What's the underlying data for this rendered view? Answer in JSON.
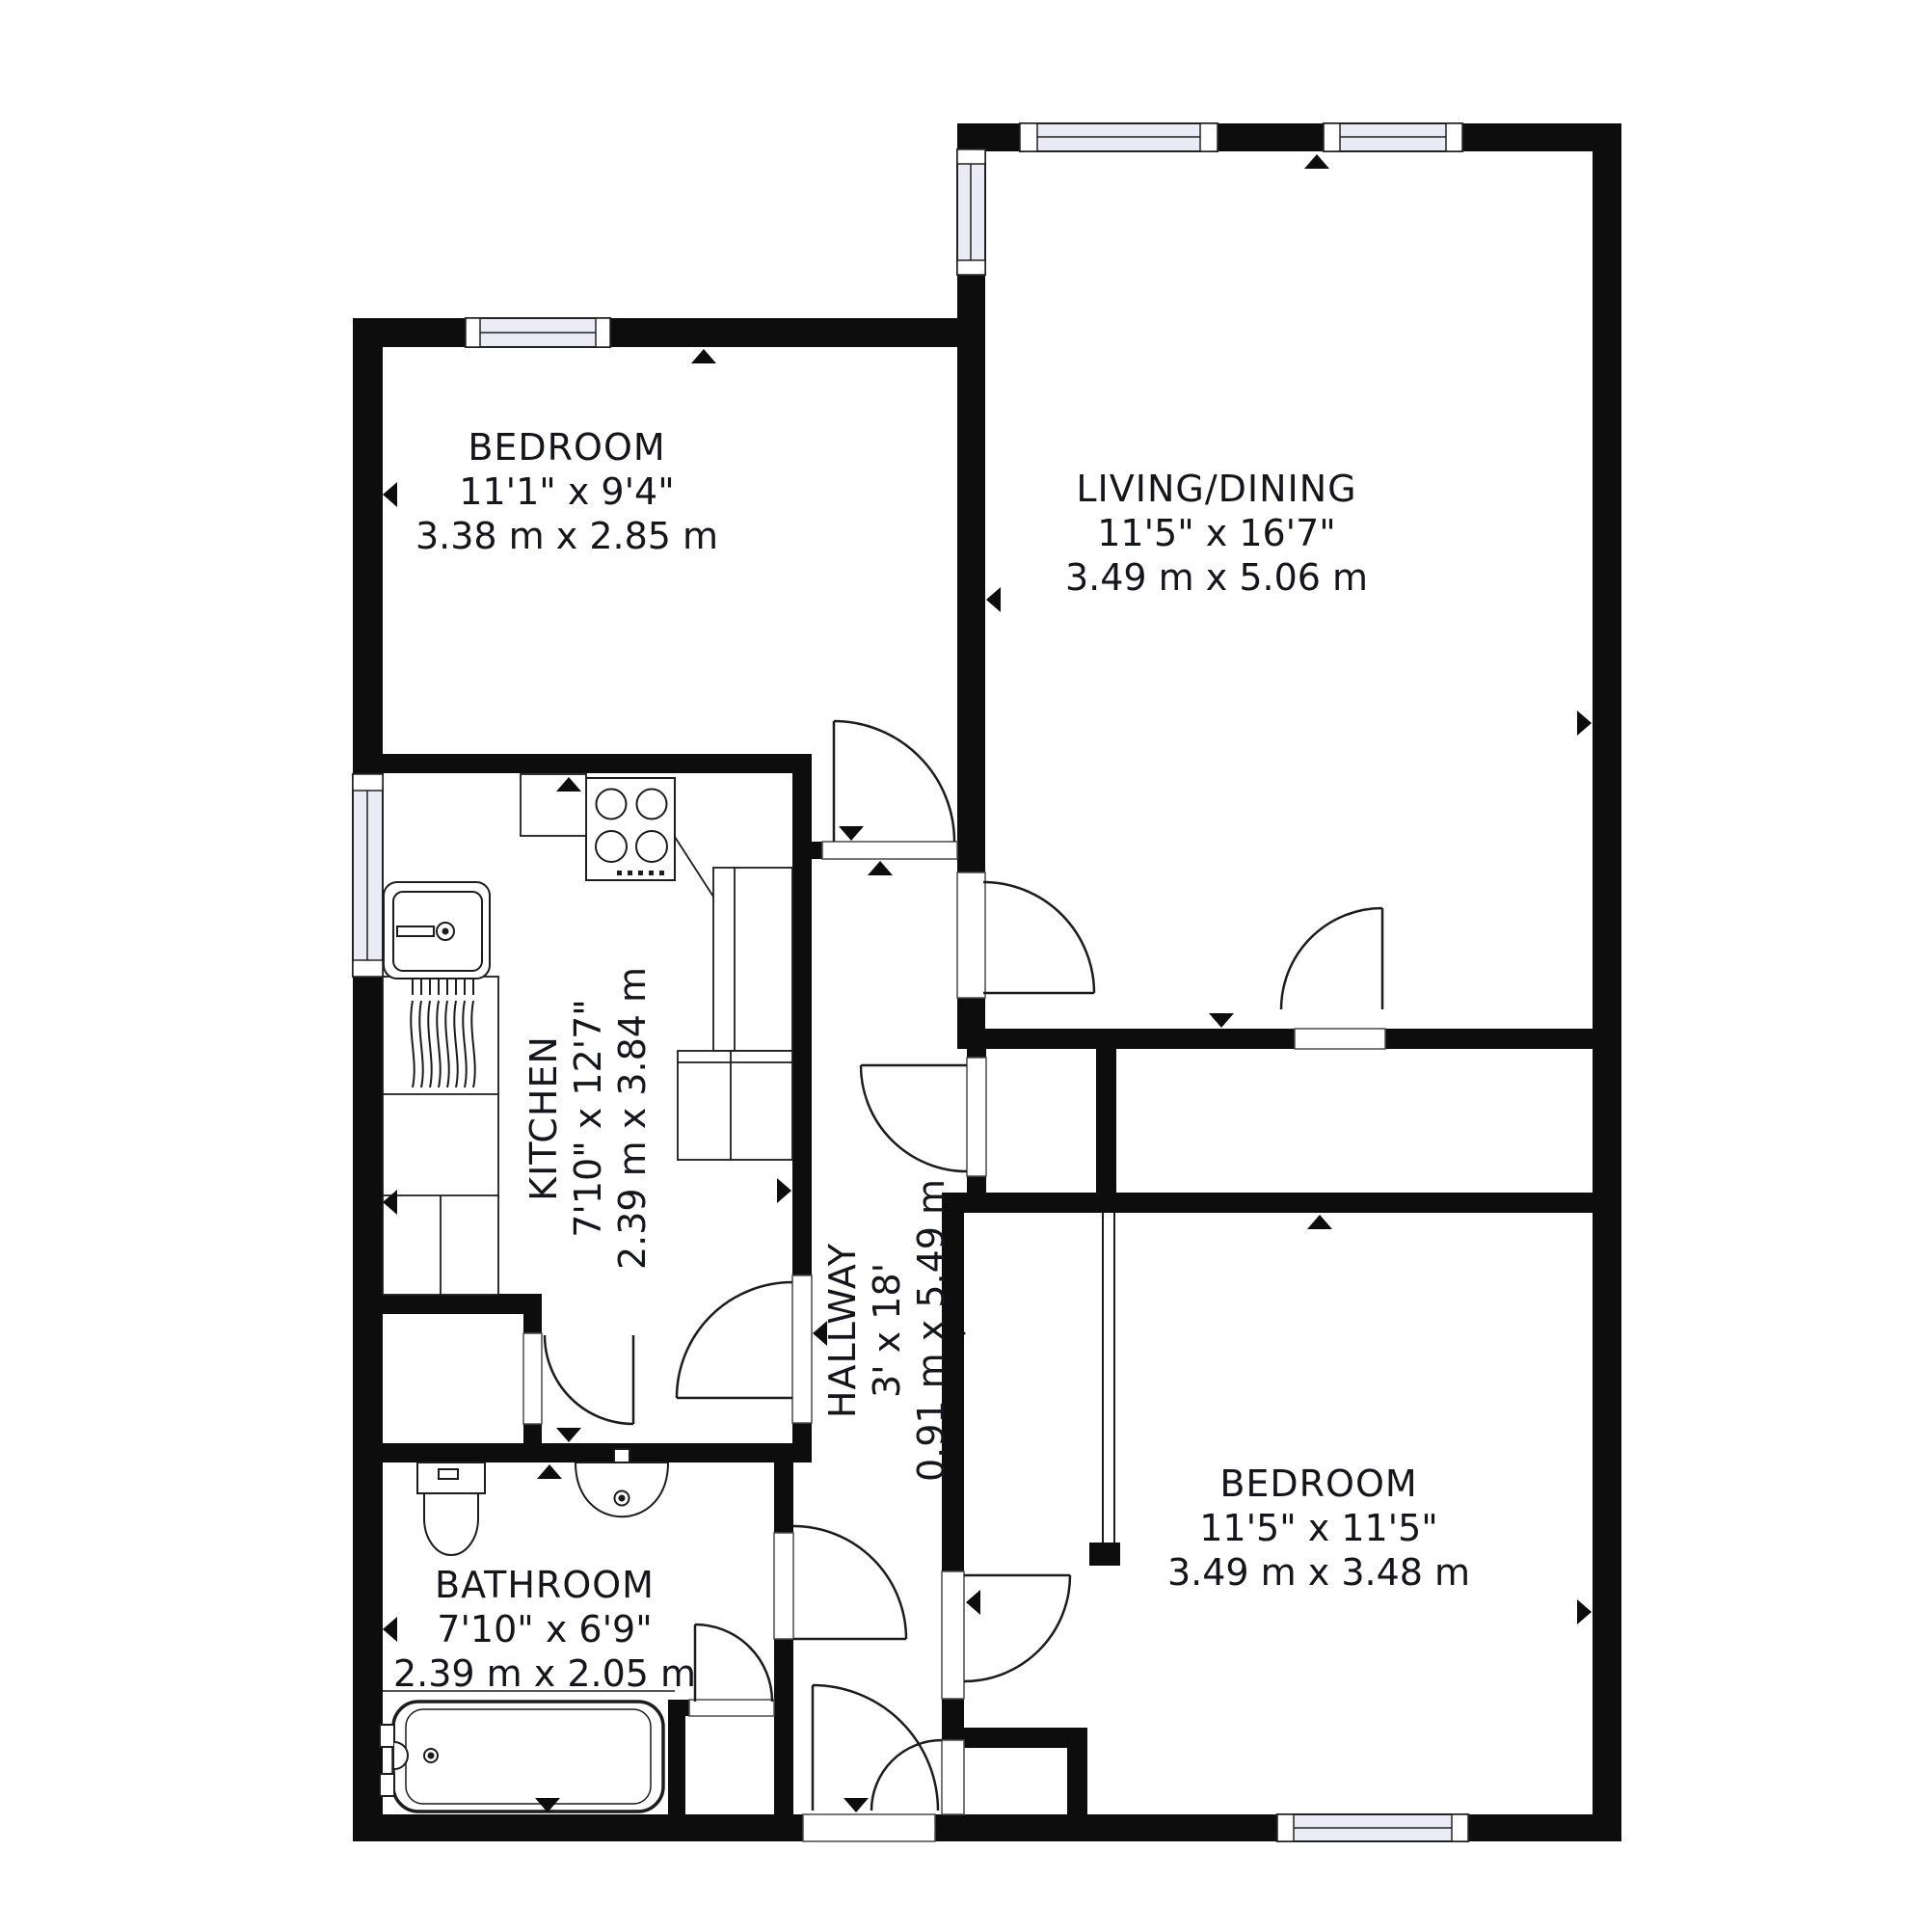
{
  "plan": {
    "title": "2 bedroom apartment floor plan",
    "rooms": [
      {
        "id": "bedroom-1",
        "name": "BEDROOM",
        "imperial": "11'1\" x 9'4\"",
        "metric": "3.38 m x 2.85 m",
        "orientation": "horizontal"
      },
      {
        "id": "living-dining",
        "name": "LIVING/DINING",
        "imperial": "11'5\" x 16'7\"",
        "metric": "3.49 m x 5.06 m",
        "orientation": "horizontal"
      },
      {
        "id": "kitchen",
        "name": "KITCHEN",
        "imperial": "7'10\" x 12'7\"",
        "metric": "2.39 m x 3.84 m",
        "orientation": "vertical"
      },
      {
        "id": "hallway",
        "name": "HALLWAY",
        "imperial": "3' x 18'",
        "metric": "0.91 m x 5.49 m",
        "orientation": "vertical"
      },
      {
        "id": "bathroom",
        "name": "BATHROOM",
        "imperial": "7'10\" x 6'9\"",
        "metric": "2.39 m x 2.05 m",
        "orientation": "horizontal"
      },
      {
        "id": "bedroom-2",
        "name": "BEDROOM",
        "imperial": "11'5\" x 11'5\"",
        "metric": "3.49 m x 3.48 m",
        "orientation": "horizontal"
      }
    ],
    "fixtures": [
      "stove-icon",
      "sink-icon",
      "drainer-icon",
      "toilet-icon",
      "washbasin-icon",
      "bathtub-icon",
      "wardrobe-icon",
      "kitchen-counter-icon"
    ],
    "colors": {
      "wall": "#0d0d0d",
      "window_fill": "#ebebf5",
      "line": "#1c1c1c",
      "text": "#15151c",
      "floor": "#ffffff"
    }
  }
}
